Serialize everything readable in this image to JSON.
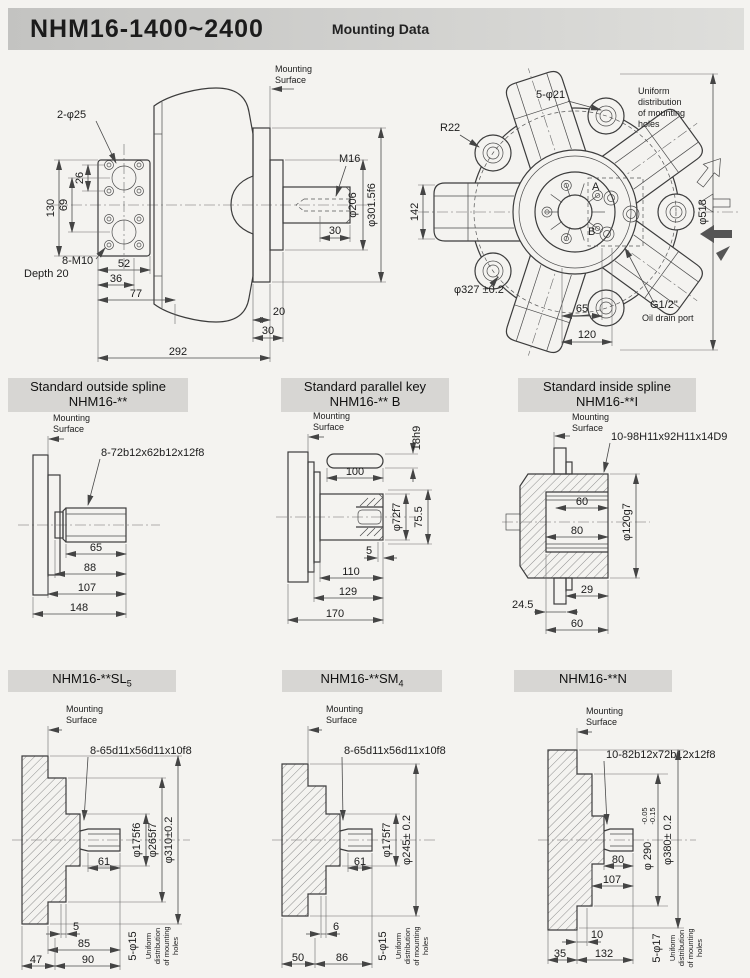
{
  "header": {
    "title": "NHM16-1400~2400",
    "subtitle": "Mounting Data"
  },
  "side_view": {
    "mounting_surface": [
      "Mounting",
      "Surface"
    ],
    "ports": "2-φ25",
    "d130": "130",
    "d26": "26",
    "d69": "69",
    "bolts": "8-M10",
    "bolts_depth": "Depth 20",
    "d52": "52",
    "d36": "36",
    "d77": "77",
    "thread": "M16",
    "dia206": "φ206",
    "dia301": "φ301.5f6",
    "d30s": "30",
    "d20": "20",
    "d30": "30",
    "d292": "292"
  },
  "front_view": {
    "holes": "5-φ21",
    "uniform": [
      "Uniform",
      "distribution",
      "of mounting",
      "holes"
    ],
    "r22": "R22",
    "d142": "142",
    "dia518": "φ518",
    "dia327": "φ327 ±0.2",
    "port_a": "A",
    "port_b": "B",
    "drain": "G1/2\"",
    "drain_label": "Oil drain port",
    "d65": "65",
    "d120": "120"
  },
  "mid": [
    {
      "t1": "Standard outside spline",
      "t2": "NHM16-**",
      "ms": [
        "Mounting",
        "Surface"
      ],
      "spline": "8-72b12x62b12x12f8",
      "d65": "65",
      "d88": "88",
      "d107": "107",
      "d148": "148"
    },
    {
      "t1": "Standard parallel key",
      "t2": "NHM16-** B",
      "ms": [
        "Mounting",
        "Surface"
      ],
      "key_h": "18h9",
      "key_l": "100",
      "dia72": "φ72f7",
      "d755": "75.5",
      "d5": "5",
      "d110": "110",
      "d129": "129",
      "d170": "170"
    },
    {
      "t1": "Standard inside spline",
      "t2": "NHM16-**I",
      "ms": [
        "Mounting",
        "Surface"
      ],
      "spline": "10-98H11x92H11x14D9",
      "d60": "60",
      "d80": "80",
      "dia120": "φ120g7",
      "d29": "29",
      "d245": "24.5",
      "d60b": "60"
    }
  ],
  "bot": [
    {
      "t": "NHM16-**SL",
      "sub": "5",
      "ms": [
        "Mounting",
        "Surface"
      ],
      "spline": "8-65d11x56d11x10f8",
      "d61": "61",
      "dia1": "φ175f6",
      "dia2": "φ265f7",
      "dia3": "φ310±0.2",
      "d5": "5",
      "d85": "85",
      "d90": "90",
      "d47": "47",
      "holes": "5-φ15",
      "uniform": [
        "Uniform",
        "distribution",
        "of mounting",
        "holes"
      ]
    },
    {
      "t": "NHM16-**SM",
      "sub": "4",
      "ms": [
        "Mounting",
        "Surface"
      ],
      "spline": "8-65d11x56d11x10f8",
      "d61": "61",
      "dia1": "φ175f7",
      "dia2": "φ245± 0.2",
      "d6": "6",
      "d50": "50",
      "d86": "86",
      "holes": "5-φ15",
      "uniform": [
        "Uniform",
        "distribution",
        "of mounting",
        "holes"
      ]
    },
    {
      "t": "NHM16-**N",
      "sub": "",
      "ms": [
        "Mounting",
        "Surface"
      ],
      "spline": "10-82b12x72b12x12f8",
      "d80": "80",
      "d107": "107",
      "dia1": "φ 290",
      "tol_t": "-0.05",
      "tol_b": "-0.15",
      "dia2": "φ380± 0.2",
      "d10": "10",
      "d35": "35",
      "d132": "132",
      "holes": "5-φ17",
      "uniform": [
        "Uniform",
        "distribution",
        "of mounting",
        "holes"
      ]
    }
  ]
}
